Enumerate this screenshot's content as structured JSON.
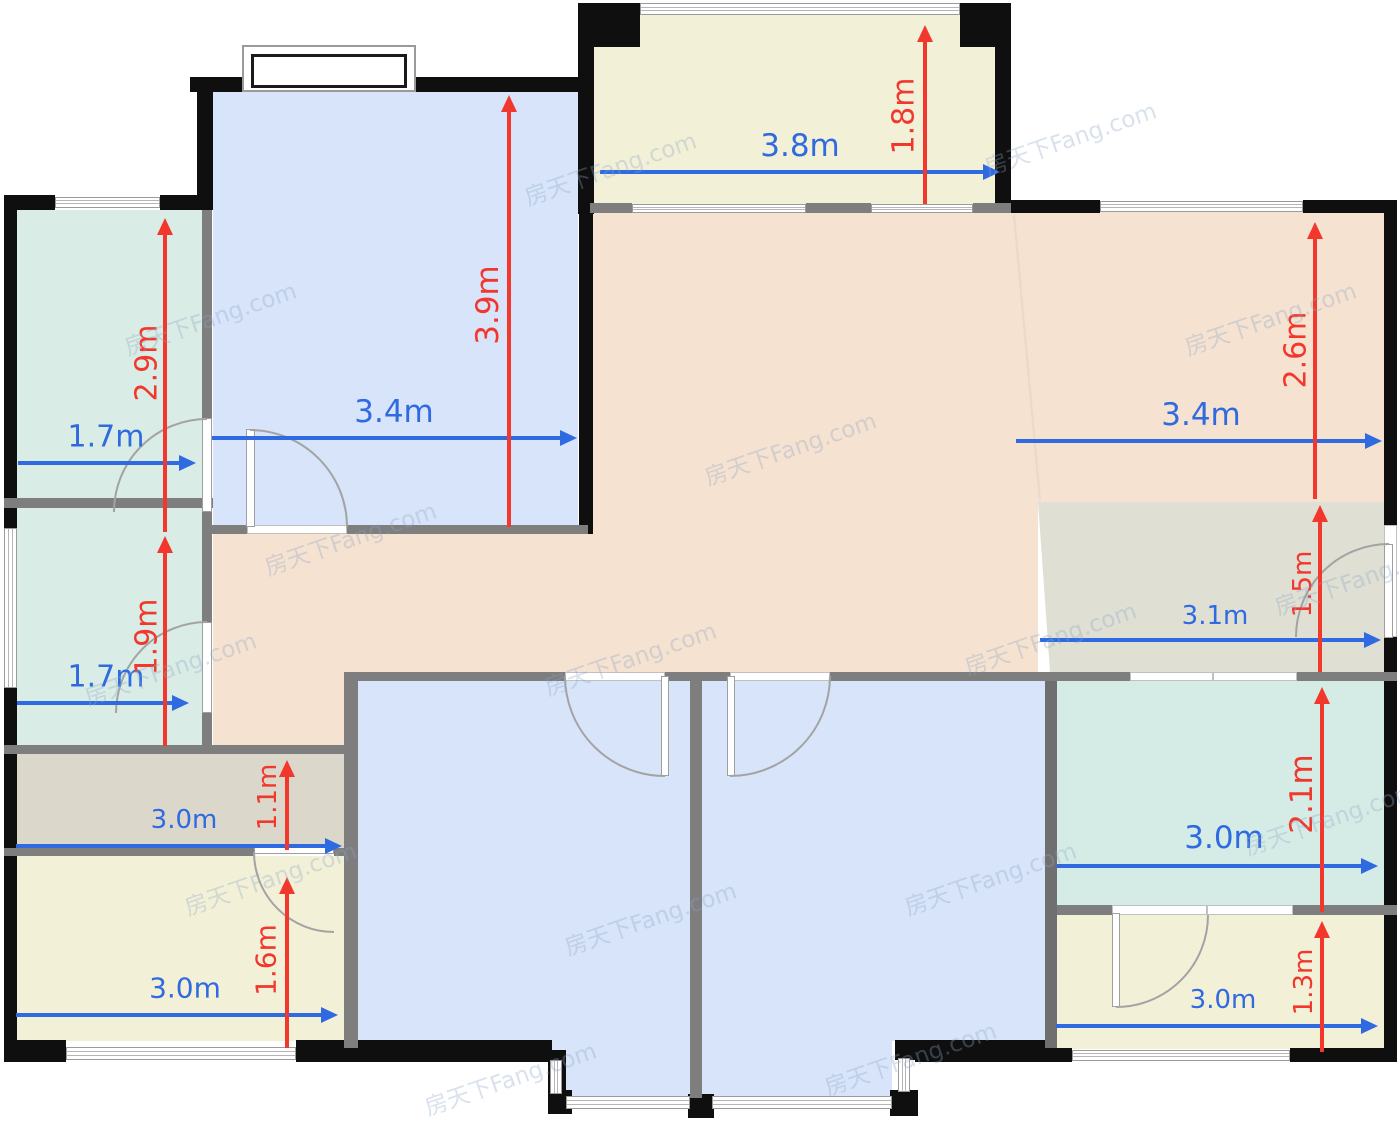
{
  "watermark": {
    "text": "房天下Fang.com"
  },
  "palette": {
    "dim_blue": "#2f6ae0",
    "dim_red": "#f2372c",
    "wall_black": "#0f0f0f",
    "wall_gray": "#7e7e7e",
    "room_bedroom_blue": "#d7e4f9",
    "room_teal": "#d9ece5",
    "room_mint": "#d5ece6",
    "room_living_peach": "#f5e2d1",
    "room_balcony_cream": "#f3f0d8",
    "room_kitchen_gray": "#dfdfd4",
    "room_bath_gray": "#dbd7ca"
  },
  "rooms": [
    {
      "name": "living-dining",
      "color": "room_living_peach",
      "x": 590,
      "y": 212,
      "w": 794,
      "h": 291
    },
    {
      "name": "living-dining",
      "color": "room_living_peach",
      "x": 590,
      "y": 502,
      "w": 448,
      "h": 171
    },
    {
      "name": "living-dining",
      "color": "room_living_peach",
      "x": 213,
      "y": 534,
      "w": 377,
      "h": 139
    },
    {
      "name": "living-dining",
      "color": "room_living_peach",
      "x": 213,
      "y": 672,
      "w": 131,
      "h": 82
    },
    {
      "name": "kitchen",
      "color": "room_kitchen_gray",
      "x": 1038,
      "y": 502,
      "w": 346,
      "h": 171,
      "clip": "polygon(0 0,100% 0,100% 100%,3.5% 100%)"
    },
    {
      "name": "bedroom-top-left",
      "color": "room_bedroom_blue",
      "x": 213,
      "y": 90,
      "w": 365,
      "h": 436
    },
    {
      "name": "teal-room-upper-left",
      "color": "room_teal",
      "x": 17,
      "y": 210,
      "w": 185,
      "h": 289
    },
    {
      "name": "teal-room-lower-left",
      "color": "room_teal",
      "x": 17,
      "y": 507,
      "w": 185,
      "h": 239
    },
    {
      "name": "balcony-top",
      "color": "room_balcony_cream",
      "x": 594,
      "y": 14,
      "w": 401,
      "h": 190
    },
    {
      "name": "mint-room-right",
      "color": "room_mint",
      "x": 1057,
      "y": 681,
      "w": 327,
      "h": 225
    },
    {
      "name": "balcony-bottom-right",
      "color": "room_balcony_cream",
      "x": 1057,
      "y": 915,
      "w": 327,
      "h": 134
    },
    {
      "name": "bathroom-left",
      "color": "room_bath_gray",
      "x": 17,
      "y": 754,
      "w": 327,
      "h": 95
    },
    {
      "name": "laundry-bottom-left",
      "color": "room_balcony_cream",
      "x": 17,
      "y": 856,
      "w": 327,
      "h": 185
    },
    {
      "name": "bedroom-bottom-left",
      "color": "room_bedroom_blue",
      "x": 358,
      "y": 681,
      "w": 332,
      "h": 360
    },
    {
      "name": "bedroom-bottom-left",
      "color": "room_bedroom_blue",
      "x": 552,
      "y": 1040,
      "w": 138,
      "h": 57
    },
    {
      "name": "bedroom-bottom-right",
      "color": "room_bedroom_blue",
      "x": 702,
      "y": 681,
      "w": 343,
      "h": 360
    },
    {
      "name": "bedroom-bottom-right",
      "color": "room_bedroom_blue",
      "x": 702,
      "y": 1040,
      "w": 190,
      "h": 57
    }
  ],
  "dimensions": {
    "horizontal": [
      {
        "label": "1.7m",
        "x1": 18,
        "x2": 196,
        "y": 463,
        "cx": 106,
        "cy": 437,
        "size": 30
      },
      {
        "label": "3.4m",
        "x1": 212,
        "x2": 577,
        "y": 438,
        "cx": 394,
        "cy": 412,
        "size": 31
      },
      {
        "label": "3.8m",
        "x1": 600,
        "x2": 1000,
        "y": 172,
        "cx": 800,
        "cy": 146,
        "size": 31
      },
      {
        "label": "3.4m",
        "x1": 1016,
        "x2": 1382,
        "y": 441,
        "cx": 1201,
        "cy": 415,
        "size": 31
      },
      {
        "label": "1.7m",
        "x1": 17,
        "x2": 189,
        "y": 703,
        "cx": 106,
        "cy": 677,
        "size": 30
      },
      {
        "label": "3.1m",
        "x1": 1040,
        "x2": 1381,
        "y": 640,
        "cx": 1215,
        "cy": 616,
        "size": 26
      },
      {
        "label": "3.0m",
        "x1": 16,
        "x2": 342,
        "y": 846,
        "cx": 184,
        "cy": 820,
        "size": 26
      },
      {
        "label": "3.0m",
        "x1": 16,
        "x2": 338,
        "y": 1015,
        "cx": 185,
        "cy": 988,
        "size": 28
      },
      {
        "label": "3.0m",
        "x1": 1057,
        "x2": 1378,
        "y": 866,
        "cx": 1224,
        "cy": 838,
        "size": 31
      },
      {
        "label": "3.0m",
        "x1": 1056,
        "x2": 1378,
        "y": 1026,
        "cx": 1223,
        "cy": 1000,
        "size": 26
      }
    ],
    "vertical": [
      {
        "label": "2.9m",
        "y1": 218,
        "y2": 532,
        "x": 165,
        "cx": 147,
        "cy": 363,
        "size": 30
      },
      {
        "label": "1.9m",
        "y1": 536,
        "y2": 746,
        "x": 165,
        "cx": 147,
        "cy": 637,
        "size": 30
      },
      {
        "label": "3.9m",
        "y1": 95,
        "y2": 527,
        "x": 509,
        "cx": 488,
        "cy": 305,
        "size": 31
      },
      {
        "label": "1.8m",
        "y1": 25,
        "y2": 204,
        "x": 925,
        "cx": 904,
        "cy": 116,
        "size": 30
      },
      {
        "label": "2.6m",
        "y1": 222,
        "y2": 499,
        "x": 1315,
        "cx": 1296,
        "cy": 350,
        "size": 30
      },
      {
        "label": "1.5m",
        "y1": 505,
        "y2": 672,
        "x": 1320,
        "cx": 1303,
        "cy": 584,
        "size": 26
      },
      {
        "label": "1.1m",
        "y1": 760,
        "y2": 850,
        "x": 287,
        "cx": 268,
        "cy": 797,
        "size": 26
      },
      {
        "label": "1.6m",
        "y1": 877,
        "y2": 1048,
        "x": 287,
        "cx": 266,
        "cy": 960,
        "size": 28
      },
      {
        "label": "2.1m",
        "y1": 687,
        "y2": 912,
        "x": 1322,
        "cx": 1302,
        "cy": 794,
        "size": 31
      },
      {
        "label": "1.3m",
        "y1": 921,
        "y2": 1052,
        "x": 1322,
        "cx": 1304,
        "cy": 982,
        "size": 26
      }
    ]
  }
}
